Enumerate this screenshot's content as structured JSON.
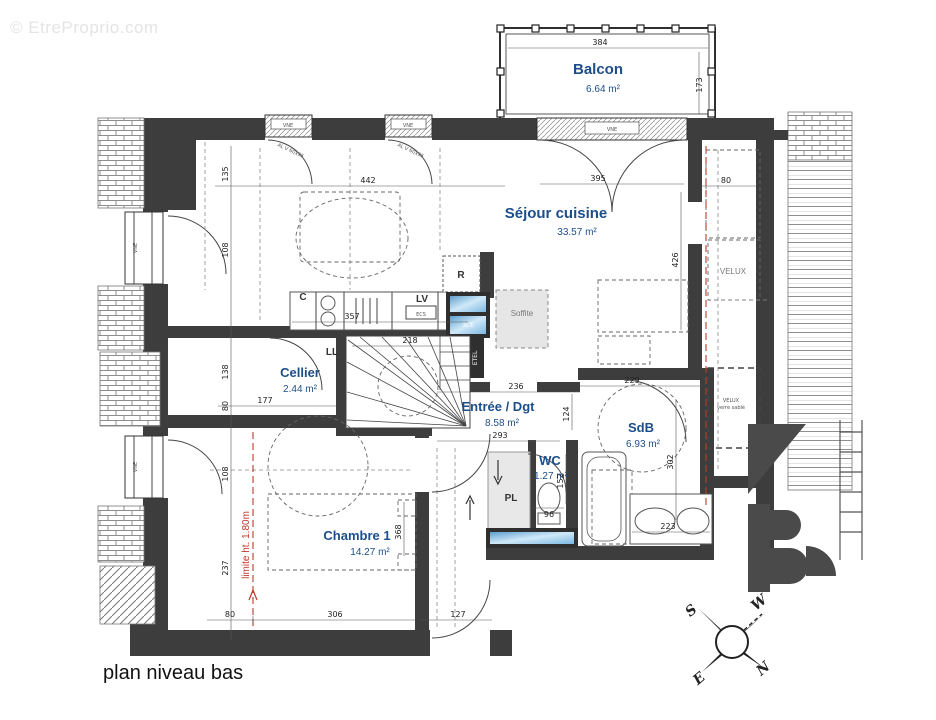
{
  "watermark": {
    "text": "© EtreProprio.com"
  },
  "title": "plan niveau bas",
  "rooms": {
    "balcon": {
      "name": "Balcon",
      "area": "6.64 m²"
    },
    "sejour": {
      "name": "Séjour cuisine",
      "area": "33.57 m²"
    },
    "cellier": {
      "name": "Cellier",
      "area": "2.44 m²"
    },
    "entree": {
      "name": "Entrée / Dgt",
      "area": "8.58 m²"
    },
    "wc": {
      "name": "WC",
      "area": "1.27 m²"
    },
    "sdb": {
      "name": "SdB",
      "area": "6.93 m²"
    },
    "chambre": {
      "name": "Chambre 1",
      "area": "14.27 m²"
    }
  },
  "labels": {
    "r": "R",
    "lv": "LV",
    "ecs": "ECS",
    "c": "C",
    "ll": "LL",
    "pl": "PL",
    "soffite": "Soffite",
    "etel": "ETEL",
    "vne": "VNE",
    "ce3": "3CE",
    "velux": "VELUX",
    "verre_sable": "verre sablé",
    "limite": "limite ht. 1.80m",
    "window_spec": "AL V 60x95"
  },
  "dimensions": {
    "balcony_w": "384",
    "balcony_h": "173",
    "top_135": "135",
    "top_108": "108",
    "sejour_442": "442",
    "door_395": "395",
    "right_80": "80",
    "sejour_426": "426",
    "kitchen_357": "357",
    "stairs_218": "218",
    "left_138": "138",
    "left_80": "80",
    "left_108": "108",
    "left_237": "237",
    "cellier_177": "177",
    "entree_236": "236",
    "entree_293": "293",
    "wc_124": "124",
    "sdb_229": "229",
    "sdb_302": "302",
    "wc_152": "152",
    "wc_96": "96",
    "sdb_223": "223",
    "chambre_368": "368",
    "bottom_80": "80",
    "bottom_306": "306",
    "bottom_127": "127"
  },
  "compass": {
    "n": "N",
    "s": "S",
    "e": "E",
    "w": "W"
  },
  "colors": {
    "wall": "#3d3d3d",
    "room_label": "#1d4e89",
    "glazing": "#6fb0dd",
    "red_line": "#c0392b"
  }
}
